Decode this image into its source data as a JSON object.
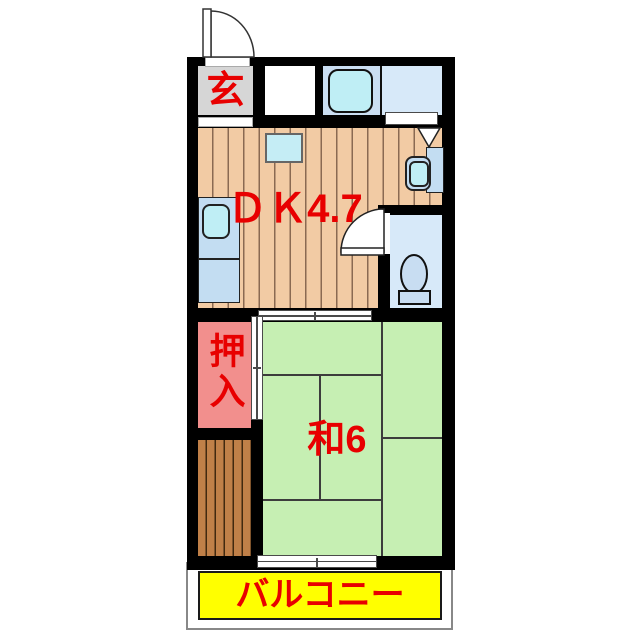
{
  "labels": {
    "genkan": "玄",
    "dk": "ＤＫ4.7",
    "oshiire": "押入",
    "washitsu": "和6",
    "balcony": "バルコニー"
  },
  "colors": {
    "wall": "#000000",
    "label-red": "#e80000",
    "genkan-bg": "#d6d6d6",
    "wood": "#f2cba4",
    "wood-line": "#8a6a52",
    "tatami": "#c6efb3",
    "tatami-line": "#3c3c3c",
    "closet-pink": "#f28f8d",
    "deck-brown": "#c08048",
    "deck-line": "#41290f",
    "bath-bg": "#cadef2",
    "washroom-bg": "#d7e9f9",
    "toilet-bg": "#d7e9f9",
    "fixture-blue": "#c3ddf2",
    "fixture-bowl": "#bfeef5",
    "balcony-yellow": "#ffff00"
  }
}
